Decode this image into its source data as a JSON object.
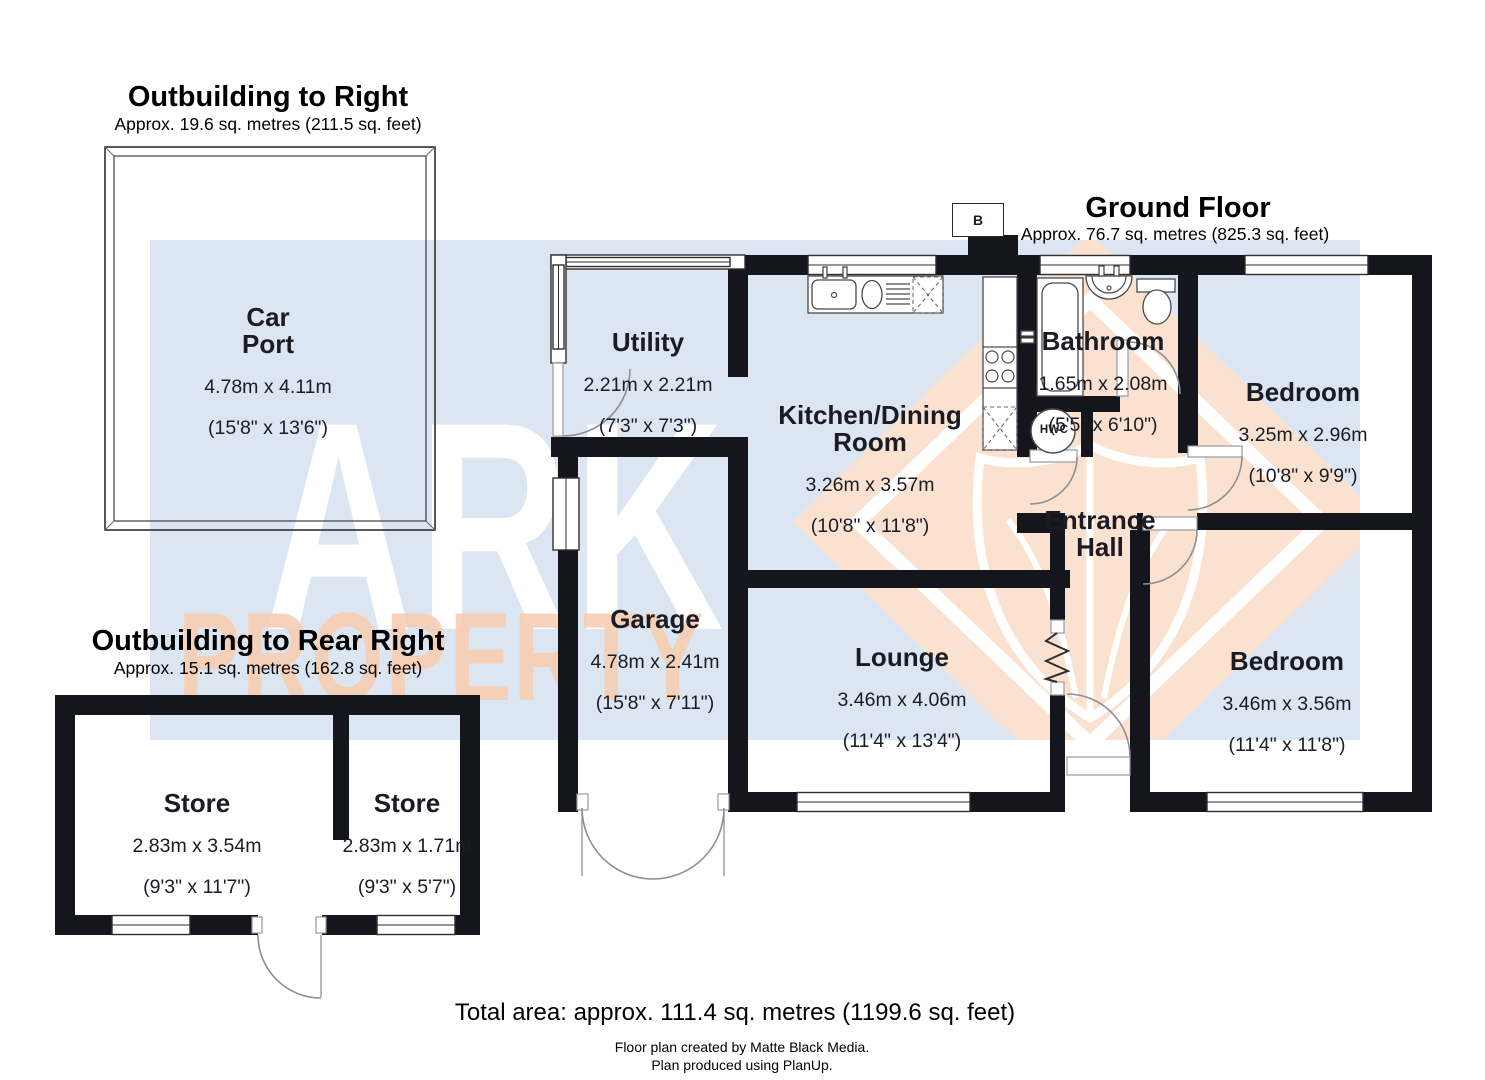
{
  "titles": {
    "outbuilding_right": {
      "title": "Outbuilding to Right",
      "subtitle": "Approx. 19.6 sq. metres (211.5 sq. feet)"
    },
    "ground_floor": {
      "title": "Ground Floor",
      "subtitle": "Approx. 76.7 sq. metres (825.3 sq. feet)"
    },
    "outbuilding_rear_right": {
      "title": "Outbuilding to Rear Right",
      "subtitle": "Approx. 15.1 sq. metres (162.8 sq. feet)"
    }
  },
  "rooms": {
    "car_port": {
      "name": "Car\nPort",
      "metric": "4.78m x 4.11m",
      "imperial": "(15'8\" x 13'6\")"
    },
    "utility": {
      "name": "Utility",
      "metric": "2.21m x 2.21m",
      "imperial": "(7'3\" x 7'3\")"
    },
    "kitchen_dining": {
      "name": "Kitchen/Dining\nRoom",
      "metric": "3.26m x 3.57m",
      "imperial": "(10'8\" x 11'8\")"
    },
    "bathroom": {
      "name": "Bathroom",
      "metric": "1.65m x 2.08m",
      "imperial": "(5'5\" x 6'10\")"
    },
    "bedroom_front": {
      "name": "Bedroom",
      "metric": "3.25m x 2.96m",
      "imperial": "(10'8\" x 9'9\")"
    },
    "entrance_hall": {
      "name": "Entrance\nHall"
    },
    "garage": {
      "name": "Garage",
      "metric": "4.78m x 2.41m",
      "imperial": "(15'8\" x 7'11\")"
    },
    "lounge": {
      "name": "Lounge",
      "metric": "3.46m x 4.06m",
      "imperial": "(11'4\" x 13'4\")"
    },
    "bedroom_rear": {
      "name": "Bedroom",
      "metric": "3.46m x 3.56m",
      "imperial": "(11'4\" x 11'8\")"
    },
    "store_large": {
      "name": "Store",
      "metric": "2.83m x 3.54m",
      "imperial": "(9'3\" x 11'7\")"
    },
    "store_small": {
      "name": "Store",
      "metric": "2.83m x 1.71m",
      "imperial": "(9'3\" x 5'7\")"
    }
  },
  "markers": {
    "boiler": "B",
    "hot_water_cylinder": "HWC"
  },
  "watermark": {
    "line1": "ARK",
    "line2": "PROPERTY"
  },
  "footer": {
    "total_area": "Total area: approx. 111.4 sq. metres (1199.6 sq. feet)",
    "credit1": "Floor plan created by Matte Black Media.",
    "credit2": "Plan produced using PlanUp."
  },
  "colors": {
    "wall": "#15151d",
    "watermark_blue": "#dbe6f2",
    "watermark_peach": "#fbe2d0",
    "watermark_peach_text": "#f8cfb5",
    "ink": "#1b1b24"
  }
}
